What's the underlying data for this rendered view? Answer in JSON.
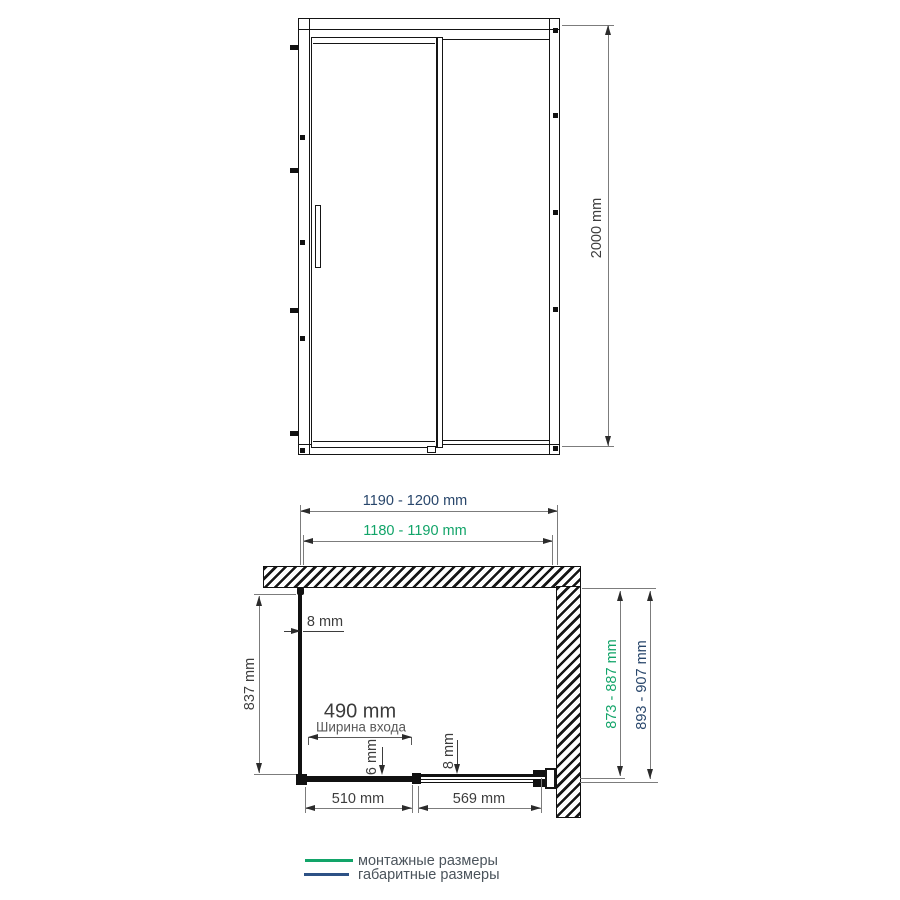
{
  "front_view": {
    "height_dim": "2000 mm"
  },
  "plan_view": {
    "overall_width": "1190 - 1200 mm",
    "mounting_width": "1180 - 1190 mm",
    "wall_glass_thickness": "8 mm",
    "side_depth": "837 mm",
    "entry_width_value": "490 mm",
    "entry_width_label": "Ширина входа",
    "door_glass_thickness": "6 mm",
    "panel_glass_thickness": "8 mm",
    "door_width": "510 mm",
    "panel_width": "569 mm",
    "mounting_depth": "873 - 887 mm",
    "overall_depth": "893 - 907 mm"
  },
  "legend": {
    "mounting_label": "монтажные размеры",
    "overall_label": "габаритные размеры"
  },
  "colors": {
    "mounting_green": "#12a469",
    "overall_navy": "#28466b",
    "drawing_line": "#151515",
    "dimension_line": "#7c7c7c"
  }
}
